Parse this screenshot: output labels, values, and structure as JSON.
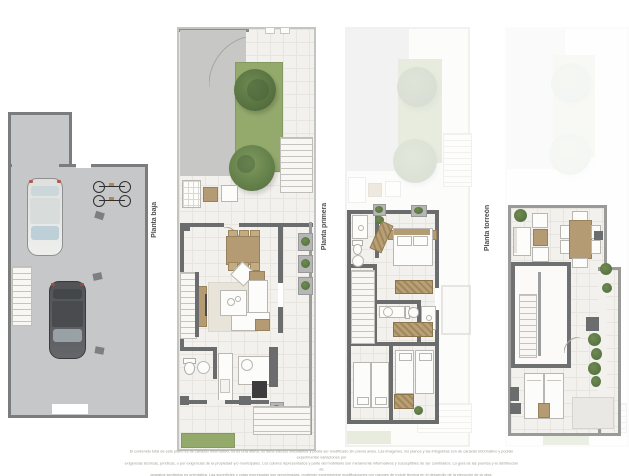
{
  "sheet": {
    "background": "#ffffff"
  },
  "floors": [
    {
      "id": "semisotano",
      "label": "Planta semisótano"
    },
    {
      "id": "baja",
      "label": "Planta baja"
    },
    {
      "id": "primera",
      "label": "Planta primera"
    },
    {
      "id": "torreon",
      "label": "Planta torreón"
    }
  ],
  "disclaimer": {
    "line1": "El contenido total de este plano es de carácter informativo, no es una oferta, no tiene efectos vinculantes y podrá ser modificado sin previo aviso. Las imágenes, los planos y las infografías son de carácter informativo y podrán experimentar variaciones por",
    "line2": "exigencias técnicas, jurídicas, o por exigencias de la propiedad y/o municipales. Los colores representados y parte del mobiliario son meramente informativos y susceptibles de ser cambiados. La guía de las puertas y la distribución de",
    "line3": "aparatos sanitarios es orientativa. Las superficies y cotas expresadas son aproximadas, pudiendo experimentar modificaciones por razones de índole técnica en el desarrollo de la ejecución de la obra."
  },
  "colors": {
    "background": "#ffffff",
    "floor": "#f3f1ed",
    "grid_line": "#e8e5df",
    "wall_dark": "#6b6c6e",
    "wall_light": "#9b9c9e",
    "garage_floor": "#c6c7c9",
    "garage_wall": "#7b7c7e",
    "grass": "#94aa6d",
    "tree": "#55703f",
    "wood": "#b49b73",
    "white_furniture": "#fcfcfb",
    "appliance_dark": "#3c3c3c",
    "label_text": "#4f4f4f",
    "disclaimer_text": "#9c9c94"
  },
  "icons": {
    "car-icon": "css-shape",
    "bicycles-icon": "css-shape",
    "stairs-icon": "css-stripes",
    "tree-icon": "css-radial-blob",
    "shrub-icon": "css-radial-blob",
    "dining-table-icon": "css-shape",
    "sofa-icon": "css-shape",
    "coffee-table-icon": "css-shape",
    "tv-cabinet-icon": "css-shape",
    "toilet-icon": "css-shape",
    "sink-icon": "css-shape",
    "shower-icon": "css-shape",
    "oven-icon": "css-shape",
    "bed-double-icon": "css-shape",
    "bed-single-icon": "css-shape",
    "wardrobe-icon": "css-hatch",
    "sun-lounger-icon": "css-shape",
    "door-arc-icon": "svg-arc",
    "planter-icon": "css-shape"
  }
}
